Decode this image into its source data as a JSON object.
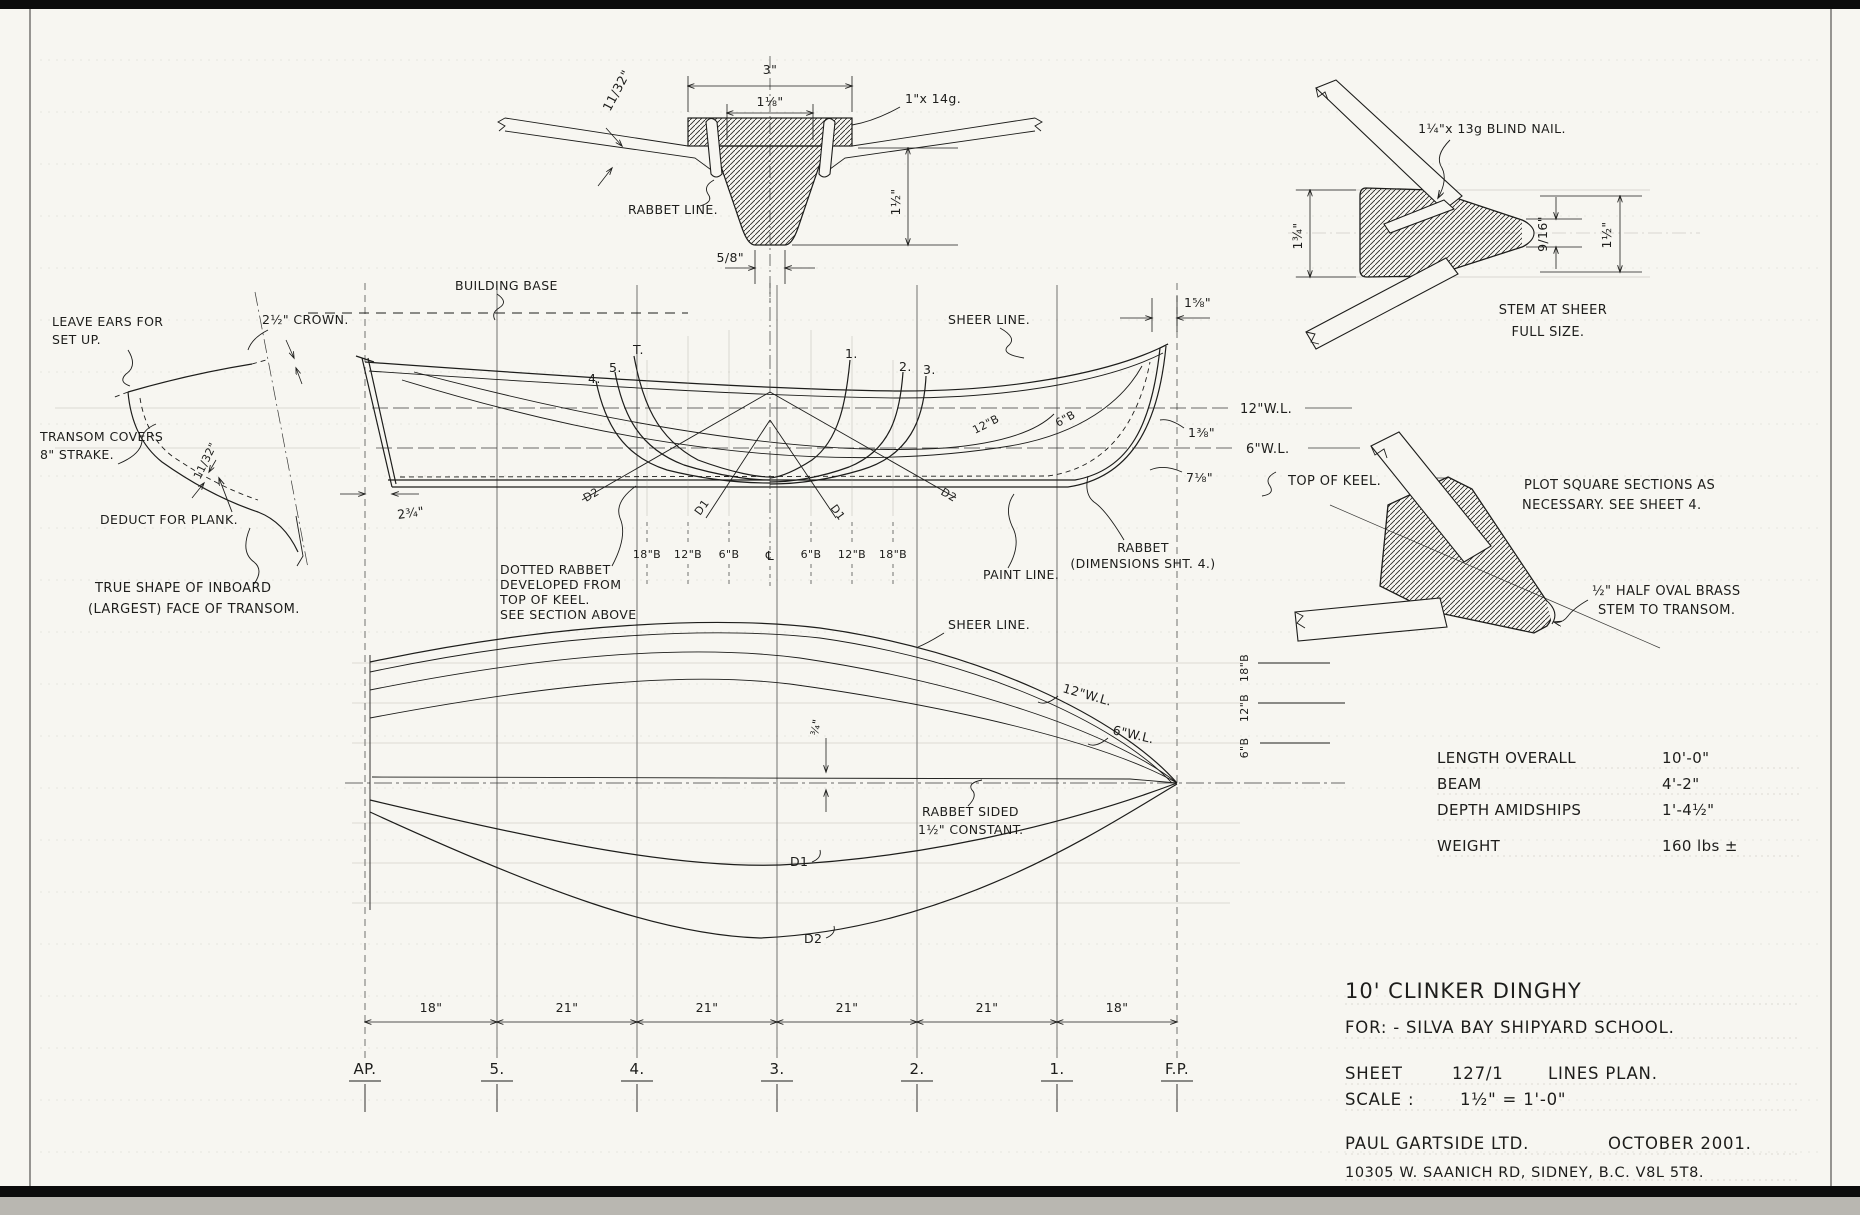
{
  "colors": {
    "paper": "#f7f6f1",
    "ink": "#1d1d1b"
  },
  "title_block": {
    "line1": "10' CLINKER DINGHY",
    "line2": "FOR: - SILVA BAY SHIPYARD SCHOOL.",
    "sheet_label": "SHEET",
    "sheet_no": "127/1",
    "sheet_title": "LINES PLAN.",
    "scale_label": "SCALE :",
    "scale_value": "1½\" = 1'-0\"",
    "company": "PAUL GARTSIDE LTD.",
    "date": "OCTOBER 2001.",
    "address": "10305 W. SAANICH RD, SIDNEY, B.C. V8L 5T8."
  },
  "particulars": {
    "rows": [
      {
        "label": "LENGTH OVERALL",
        "value": "10'-0\""
      },
      {
        "label": "BEAM",
        "value": "4'-2\""
      },
      {
        "label": "DEPTH AMIDSHIPS",
        "value": "1'-4½\""
      },
      {
        "label": "WEIGHT",
        "value": "160 lbs ±"
      }
    ]
  },
  "keel_section": {
    "dim_top": "3\"",
    "dim_inner": "1⅛\"",
    "note_fastening": "1\"x 14g.",
    "dim_plank": "11/32\"",
    "rabbet_line": "RABBET LINE.",
    "dim_bottom": "5/8\"",
    "dim_depth": "1½\""
  },
  "stem_detail": {
    "note_nail": "1¼\"x 13g BLIND NAIL.",
    "dim_left": "1¾\"",
    "dim_nose": "9/16\"",
    "dim_right": "1½\"",
    "caption1": "STEM AT SHEER",
    "caption2": "FULL SIZE."
  },
  "transom_detail": {
    "note_ears1": "LEAVE EARS FOR",
    "note_ears2": "SET UP.",
    "dim_crown": "2½\" CROWN.",
    "note_covers1": "TRANSOM COVERS",
    "note_covers2": "8\" STRAKE.",
    "dim_plank": "11/32\"",
    "note_deduct": "DEDUCT FOR PLANK.",
    "caption1": "TRUE SHAPE OF INBOARD",
    "caption2": "(LARGEST) FACE OF TRANSOM."
  },
  "profile": {
    "building_base": "BUILDING BASE",
    "sheer_line": "SHEER LINE.",
    "dim_stem_head": "1⅝\"",
    "wl12": "12\"W.L.",
    "wl6": "6\"W.L.",
    "dim_sheer_fwd": "1⅜\"",
    "dim_keel_fwd": "7⅛\"",
    "top_of_keel": "TOP OF KEEL.",
    "rabbet1": "RABBET",
    "rabbet2": "(DIMENSIONS SHT. 4.)",
    "paint_line": "PAINT LINE.",
    "dim_transom": "2¾\"",
    "butt12": "12\"B",
    "butt6": "6\"B",
    "note_rabbet1": "DOTTED RABBET",
    "note_rabbet2": "DEVELOPED FROM",
    "note_rabbet3": "TOP OF KEEL.",
    "note_rabbet4": "SEE SECTION ABOVE",
    "sections_left": [
      "4.",
      "5.",
      "T."
    ],
    "sections_right": [
      "1.",
      "2.",
      "3."
    ],
    "grid_labels": [
      "18\"B",
      "12\"B",
      "6\"B",
      "℄",
      "6\"B",
      "12\"B",
      "18\"B"
    ],
    "d1": "D1",
    "d2": "D2"
  },
  "plan": {
    "sheer_line": "SHEER LINE.",
    "wl12": "12\"W.L.",
    "wl6": "6\"W.L.",
    "dim_rabbet_half": "¾\"",
    "note_rabbet1": "RABBET SIDED",
    "note_rabbet2": "1½\" CONSTANT.",
    "d1": "D1",
    "d2": "D2",
    "scale_labels": [
      "18\"B",
      "12\"B",
      "6\"B"
    ]
  },
  "stem_plan": {
    "note1": "PLOT SQUARE SECTIONS AS",
    "note2": "NECESSARY.  SEE SHEET 4.",
    "note3": "½\" HALF OVAL BRASS",
    "note4": "STEM TO TRANSOM."
  },
  "stations": {
    "labels": [
      "AP.",
      "5.",
      "4.",
      "3.",
      "2.",
      "1.",
      "F.P."
    ],
    "spacings": [
      "18\"",
      "21\"",
      "21\"",
      "21\"",
      "21\"",
      "18\""
    ]
  }
}
